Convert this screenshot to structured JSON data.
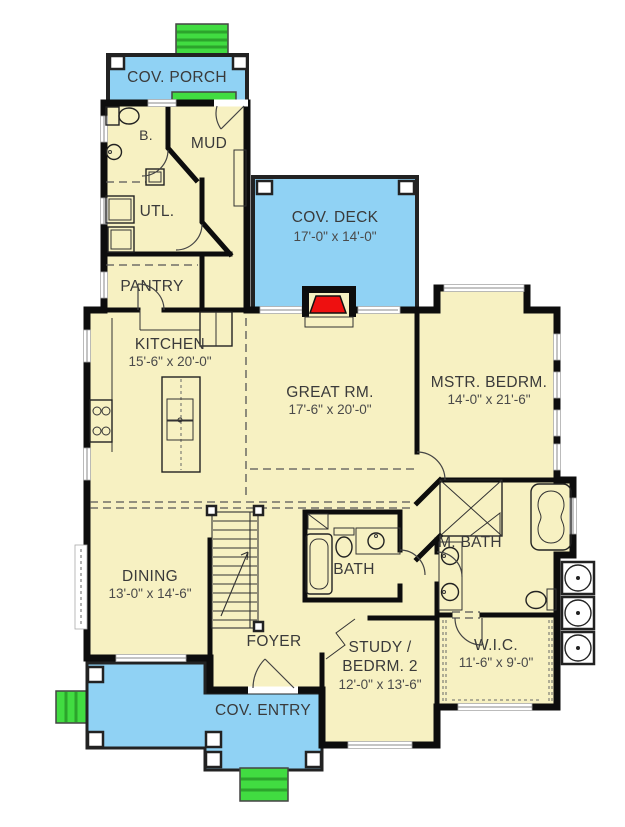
{
  "colors": {
    "floor": "#F7F1C2",
    "porch": "#90D2F4",
    "steps": "#41DC41",
    "stepline": "#2CA42C",
    "wall": "#0D0D0D",
    "accent": "#EE1010",
    "label": "#3A3A3A",
    "window": "#999999",
    "bg": "#FFFFFF"
  },
  "rooms": {
    "cov_porch": {
      "label": "COV. PORCH"
    },
    "b": {
      "label": "B."
    },
    "mud": {
      "label": "MUD"
    },
    "utl": {
      "label": "UTL."
    },
    "pantry": {
      "label": "PANTRY"
    },
    "kitchen": {
      "label": "KITCHEN",
      "dims": "15'-6\" x 20'-0\""
    },
    "cov_deck": {
      "label": "COV. DECK",
      "dims": "17'-0\" x 14'-0\""
    },
    "great_rm": {
      "label": "GREAT RM.",
      "dims": "17'-6\" x 20'-0\""
    },
    "mstr_bedrm": {
      "label": "MSTR. BEDRM.",
      "dims": "14'-0\" x 21'-6\""
    },
    "m_bath": {
      "label": "M. BATH"
    },
    "bath": {
      "label": "BATH"
    },
    "dining": {
      "label": "DINING",
      "dims": "13'-0\" x 14'-6\""
    },
    "foyer": {
      "label": "FOYER"
    },
    "study": {
      "label_line1": "STUDY /",
      "label_line2": "BEDRM. 2",
      "dims": "12'-0\" x 13'-6\""
    },
    "wic": {
      "label": "W.I.C.",
      "dims": "11'-6\" x 9'-0\""
    },
    "cov_entry": {
      "label": "COV. ENTRY"
    }
  }
}
